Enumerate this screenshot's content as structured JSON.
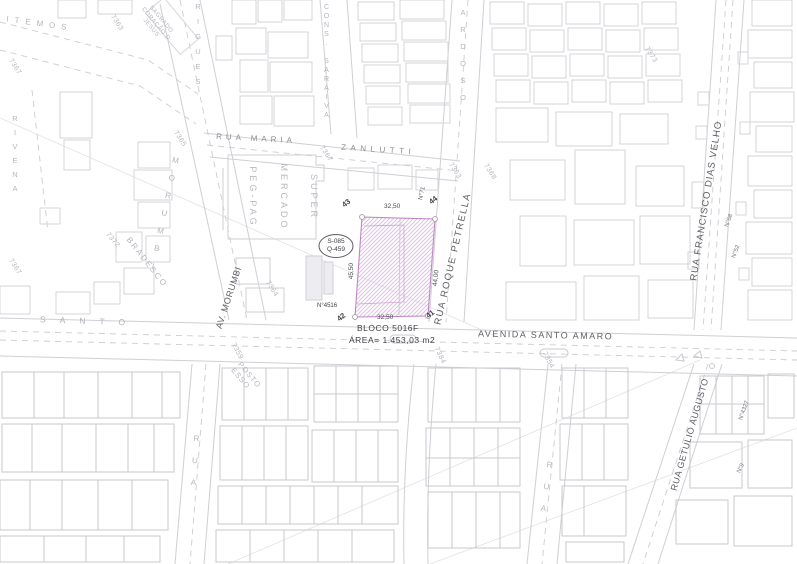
{
  "colors": {
    "lot_outline": "#c184c8",
    "lot_hatch": "#dec2e6",
    "building_line": "#d4d4d9",
    "building_line_dark": "#c9c9cf",
    "street_line": "#cfcfd5",
    "label_dark": "#3f3f45",
    "label_street": "#5f5f65",
    "label_faint": "#b5b5bd"
  },
  "lot": {
    "block": "BLOCO 5016F",
    "area": "ÁREA= 1.453,03 m2",
    "sector_ref": [
      "S-085",
      "Q-459"
    ],
    "corner_top_left": "43",
    "corner_top_right": "44",
    "corner_bottom_right": "41",
    "corner_bottom_left": "42",
    "dim_top": "32,50",
    "dim_bottom": "32,50",
    "dim_left": "45,50",
    "dim_right": "44,00",
    "number_west": "N°4516",
    "number_north": "N°71"
  },
  "streets": {
    "avenida_santo_amaro": "AVENIDA SANTO AMARO",
    "santo_spaced": "SANTO",
    "av_morumbi": "AV. MORUMBI",
    "morumbi_spaced": "MORUMBI",
    "rua_maria": "RUA MARIA",
    "zanlutti": "ZANLUTTI",
    "rua_roque_petrella": "RUA ROQUE PETRELLA",
    "rua_francisco_dias_velho": "RUA FRANCISCO DIAS VELHO",
    "rua_getulio_augusto": "RUA GETULIO AUGUSTO",
    "cons_saraiva": "CONS. SARAIVA",
    "cardoso_fragment": "ARDOSO",
    "rodrigues_fragment": "RIGUES",
    "itemos_fragment": "ITEMOS",
    "rivena": "RIVENA",
    "rua_generic_left": "RUA",
    "rua_generic_right": "RUA"
  },
  "places": {
    "supermarket": [
      "SUPER",
      "MERCADO",
      "PEG-PAG"
    ],
    "bradesco": "BRADESCO",
    "posto_esso": [
      "POSTO",
      "ESSO"
    ],
    "sagrado": [
      "SAGRADO",
      "CORAÇÃO D",
      "JESUS"
    ]
  },
  "house_numbers": {
    "n58": "N°58",
    "n52": "N°52",
    "n4327": "N°4327",
    "n9": "N°9"
  },
  "survey_marks": {
    "m7363a": "7363",
    "m7363b": "7363",
    "m7364": "7364",
    "m7365": "7365",
    "m7367a": "7367",
    "m7367b": "7367",
    "m7367c": "7367",
    "m7368": "7368",
    "m7372": "7372",
    "m7373": "7373",
    "m7359": "7359",
    "m7384": "7384",
    "m7354": "7354"
  }
}
